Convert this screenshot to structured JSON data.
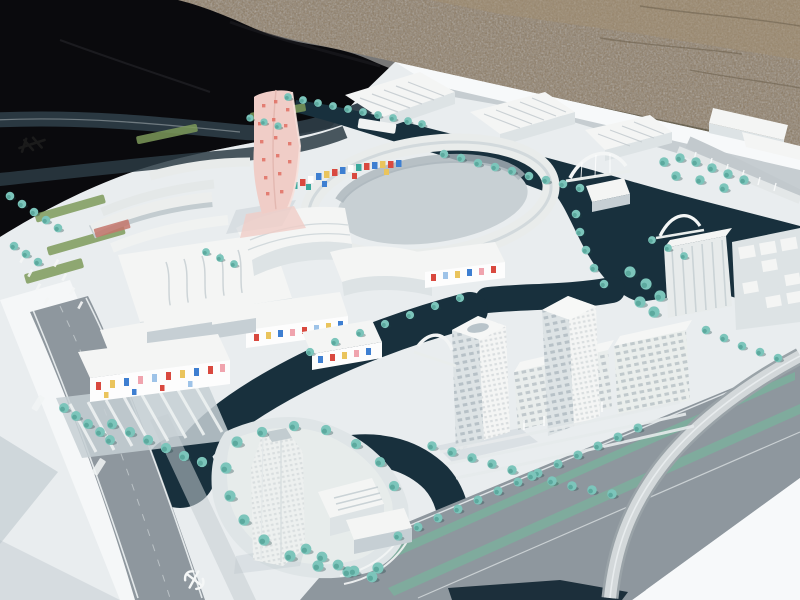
{
  "scene": {
    "type": "photograph",
    "subject": "Architectural scale model of a canal-side urban masterplan on a white base board, photographed outdoors",
    "environment": "model board lying on sandy gravel ground, black tarp at upper left",
    "lighting": "bright sunlight from upper right"
  },
  "palette": {
    "sand": "#8e7d63",
    "sand_light": "#a59070",
    "tarp": "#0a0a0d",
    "board": "#e9edef",
    "board_bright": "#f7f9fa",
    "shadow": "#b9c4cb",
    "water": "#18303d",
    "water_deep": "#0f2330",
    "tree": "#7cc5bb",
    "tree_dark": "#4f9d92",
    "grass": "#7e9a5a",
    "road": "#8e979e",
    "road_light": "#c6cdd1",
    "median": "#7cae9c",
    "building_top": "#f4f5f4",
    "building_side": "#dde3e5",
    "building_front": "#c6cfd4",
    "pink_tower": "#f0cdc7",
    "pink_dot": "#e06a5e",
    "mosaic_red": "#d9493f",
    "mosaic_blue": "#3e7fd1",
    "mosaic_teal": "#3aa99c",
    "mosaic_yellow": "#eac45c",
    "mosaic_pink": "#f0a4ae",
    "mosaic_lblue": "#9ec3e8",
    "dark_ribbon": "#2c3b44",
    "emblem_dark": "#1b1b1b",
    "emblem_white": "#f5f7f7"
  },
  "markings": {
    "board_emblem": {
      "description": "small dark rail-operator emblem printed on white board margin",
      "color": "#1b1b1b"
    },
    "road_emblem": {
      "description": "small white rail-operator emblem printed on main road near bottom",
      "color": "#f5f7f7"
    },
    "road_name_labels": {
      "count": 2,
      "description": "tiny illegible white road-name labels on left boulevard",
      "color": "#f2f5f5"
    }
  },
  "landmarks": [
    {
      "name": "pink-spiral-tower",
      "description": "twisting pink high-rise speckled with red window dots"
    },
    {
      "name": "circular-ring-building",
      "description": "O-shaped courtyard building with multicolour mosaic inner facade"
    },
    {
      "name": "mosaic-facade-blocks",
      "description": "low slabs with scattered red / yellow / blue / teal tiles"
    },
    {
      "name": "confetti-facade-building",
      "description": "long slab with confetti-coloured window tiles beside striped plaza"
    },
    {
      "name": "island-tower",
      "description": "tall translucent white tower on a landscaped island ringed by trees"
    },
    {
      "name": "office-towers",
      "description": "two white gridded towers with connecting window-grid slabs"
    },
    {
      "name": "courtyard-block-cluster",
      "description": "dense cluster of small white courtyard blocks at right"
    },
    {
      "name": "exhibition-halls",
      "description": "ridge-roofed halls along the upper canal"
    },
    {
      "name": "arch-bridges",
      "description": "three white arched bridges over the canals"
    },
    {
      "name": "flyover-ramp",
      "description": "curved elevated road ramp sweeping across the lower-right boulevard"
    },
    {
      "name": "canals",
      "description": "dark navy water channels lined with teal model trees"
    }
  ]
}
